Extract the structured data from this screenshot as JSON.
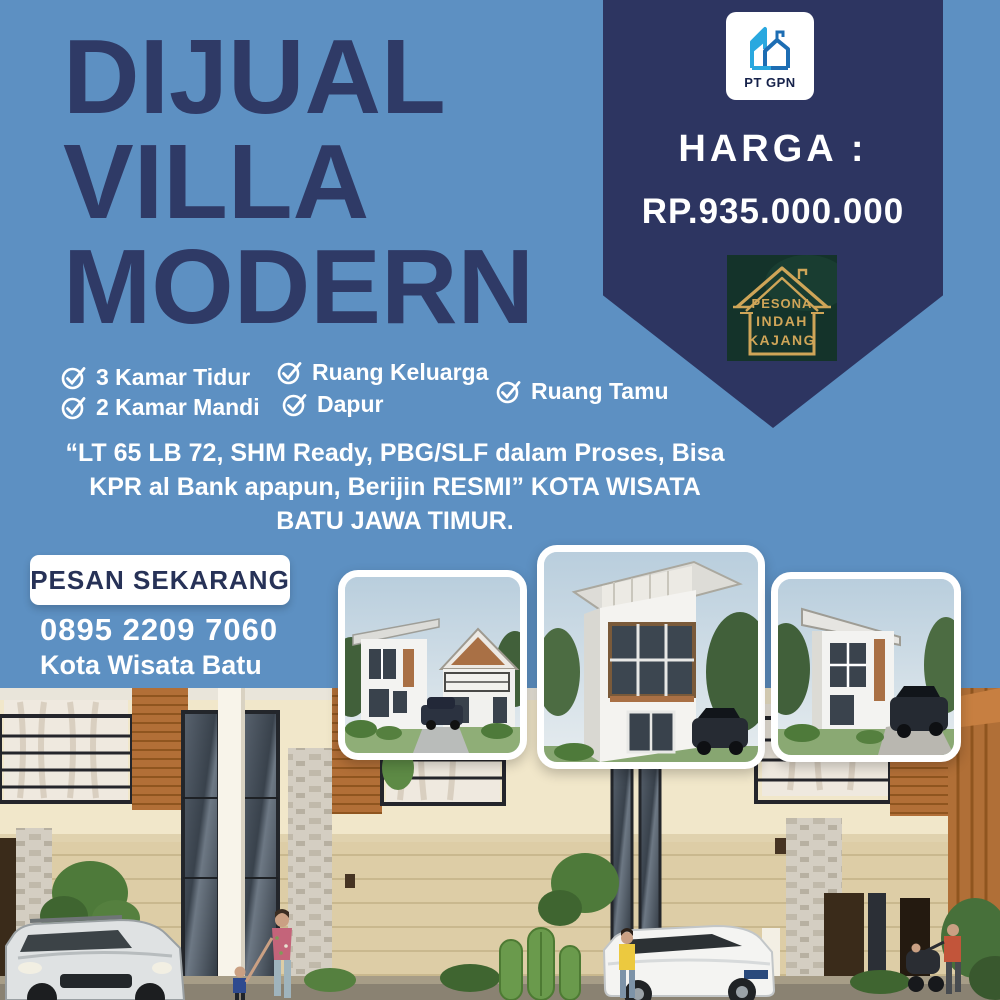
{
  "poster": {
    "title_lines": [
      "DIJUAL",
      "VILLA",
      "MODERN"
    ],
    "brand_badge": {
      "name": "PT GPN"
    },
    "price": {
      "label": "HARGA :",
      "value": "RP.935.000.000"
    },
    "developer_badge": {
      "lines": [
        "PESONA",
        "INDAH",
        "KAJANG"
      ]
    },
    "features": [
      {
        "label": "3 Kamar Tidur"
      },
      {
        "label": "2 Kamar Mandi"
      },
      {
        "label": "Ruang Keluarga"
      },
      {
        "label": "Dapur"
      },
      {
        "label": "Ruang Tamu"
      }
    ],
    "description_lines": [
      "“LT 65 LB 72, SHM Ready, PBG/SLF dalam Proses, Bisa",
      "KPR al Bank apapun, Berijin RESMI” KOTA WISATA",
      "BATU JAWA TIMUR."
    ],
    "cta": {
      "button_label": "PESAN SEKARANG",
      "phone": "0895 2209 7060",
      "location": "Kota Wisata Batu"
    },
    "icons": {
      "feature-check-icon": "✓",
      "pt-gpn-building-icon": "blue buildings outline",
      "pesona-house-icon": "gold house outline"
    },
    "colors": {
      "background": "#5d90c2",
      "ribbon": "#2d3561",
      "title_text": "#2f3a66",
      "text_white": "#ffffff",
      "logo_green_bg": "#14332a",
      "logo_gold": "#cfa558",
      "logo_blue_light": "#29a8df",
      "logo_blue_dark": "#1d6db3"
    }
  }
}
